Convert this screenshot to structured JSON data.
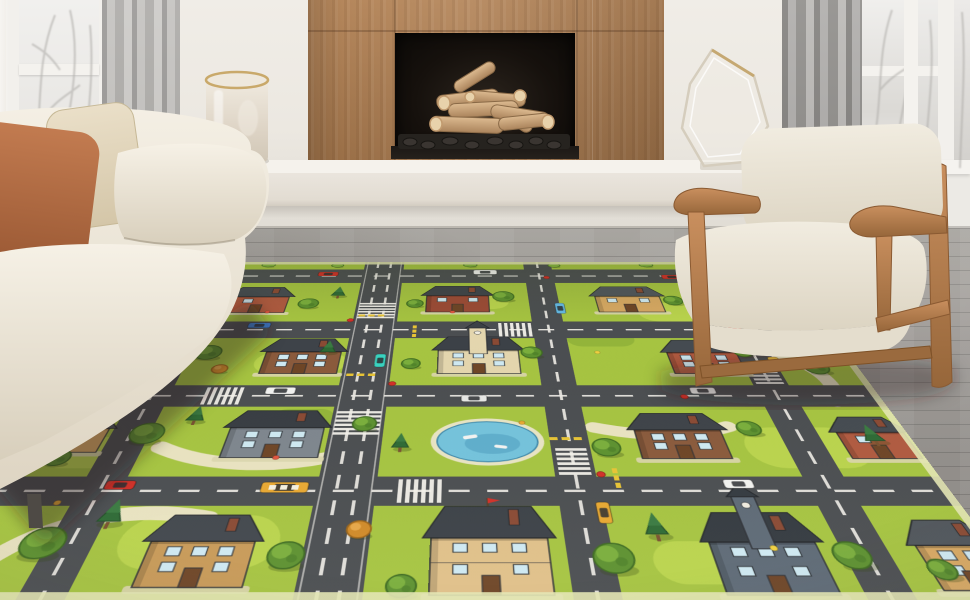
{
  "palette": {
    "wall": "#ece8e1",
    "floor1": "#a8a5a0",
    "floor2": "#8b8884",
    "wood1": "#b5875c",
    "wood2": "#9a6f47",
    "bench": "#f5f2ec",
    "benchFace": "#eae5dd",
    "curtL1": "#c2c0bd",
    "curtL2": "#979593",
    "curtR1": "#aeacaa",
    "curtR2": "#82807d",
    "sofa1": "#f4efe4",
    "sofa2": "#ded5c3",
    "pillowRust1": "#c27b50",
    "pillowRust2": "#9c5a35",
    "pillowCream1": "#eadfc8",
    "pillowCream2": "#d4c6a8",
    "chairWood1": "#c98f5e",
    "chairWood2": "#96663a",
    "chairFab1": "#f1ece0",
    "chairFab2": "#dcd4c2",
    "log1": "#dcba90",
    "log2": "#ab845c"
  },
  "objects": {
    "left_window": "snowy-window",
    "right_window": "snowy-window",
    "fireplace": "wood-surround-fireplace-with-logs",
    "bench": "floating-white-bench",
    "vase": "frosted-cylinder-vase",
    "sculpture": "glass-diamond-sculpture",
    "sofa": "cream-sofa-with-two-pillows",
    "armchair": "wood-frame-cream-armchair",
    "rug": "kids-city-road-play-rug"
  },
  "rug_map": {
    "width": 1100,
    "height": 760,
    "colors": {
      "grass": "#a6c441",
      "grassLight": "#bdd750",
      "grassDark": "#8fb239",
      "road": "#4b4e51",
      "roadLine": "#eceae4",
      "path": "#ece5c8",
      "treeDark": "#3e6b21",
      "tree1": "#5d9130",
      "tree2": "#7aae3c",
      "pine": "#2e6a35",
      "autumn": "#d08a28",
      "bush": "#86b53e",
      "pond": "#74c3dc",
      "pondDeep": "#4e9dc0",
      "sand": "#e8e4c4",
      "edge": "#e4e7b4",
      "terrace": "#dcd6ae",
      "yellow": "#e8c435",
      "red": "#d23028"
    },
    "h_roads": [
      {
        "y": 30,
        "h": 50
      },
      {
        "y": 210,
        "h": 50
      },
      {
        "y": 385,
        "h": 50
      },
      {
        "y": 575,
        "h": 50
      }
    ],
    "v_roads": [
      {
        "x": 130,
        "w": 48
      },
      {
        "x": 411,
        "w": 68
      },
      {
        "x": 676,
        "w": 48
      },
      {
        "x": 964,
        "w": 48
      }
    ],
    "patches": [
      {
        "x": 40,
        "y": 120,
        "w": 120,
        "h": 60,
        "t": "light"
      },
      {
        "x": 250,
        "y": 300,
        "w": 130,
        "h": 55,
        "t": "light"
      },
      {
        "x": 820,
        "y": 150,
        "w": 130,
        "h": 60,
        "t": "light"
      },
      {
        "x": 180,
        "y": 640,
        "w": 170,
        "h": 80,
        "t": "light"
      },
      {
        "x": 890,
        "y": 480,
        "w": 150,
        "h": 80,
        "t": "light"
      },
      {
        "x": 500,
        "y": 120,
        "w": 120,
        "h": 50,
        "t": "light"
      },
      {
        "x": 40,
        "y": 500,
        "w": 110,
        "h": 60,
        "t": "light"
      },
      {
        "x": 740,
        "y": 680,
        "w": 150,
        "h": 60,
        "t": "light"
      },
      {
        "x": 60,
        "y": 240,
        "w": 90,
        "h": 40,
        "t": "dark"
      },
      {
        "x": 700,
        "y": 240,
        "w": 100,
        "h": 44,
        "t": "dark"
      },
      {
        "x": 300,
        "y": 440,
        "w": 80,
        "h": 40,
        "t": "dark"
      }
    ],
    "paths": [
      "M30,760 C60,650 170,620 265,645",
      "M985,300 C1040,330 1060,380 1035,425",
      "M930,112 C1000,140 1040,180 1058,235",
      "M175,520 C240,558 320,560 382,540",
      "M710,480 C770,500 830,500 880,478"
    ],
    "pond": {
      "cx": 575,
      "cy": 508,
      "rx": 62,
      "ry": 40
    },
    "houses": [
      {
        "x": 170,
        "y": 96,
        "w": 96,
        "h": 86,
        "wall": "#b05a40",
        "roof": "#454b51",
        "type": "plain"
      },
      {
        "x": 488,
        "y": 92,
        "w": 100,
        "h": 88,
        "wall": "#9c4a36",
        "roof": "#3f444a",
        "type": "plain"
      },
      {
        "x": 760,
        "y": 94,
        "w": 104,
        "h": 86,
        "wall": "#d8a963",
        "roof": "#50565c",
        "type": "plain"
      },
      {
        "x": 1010,
        "y": 100,
        "w": 86,
        "h": 82,
        "wall": "#a84f38",
        "roof": "#44494f",
        "type": "plain"
      },
      {
        "x": 10,
        "y": 268,
        "w": 90,
        "h": 92,
        "wall": "#ab5340",
        "roof": "#474d53",
        "type": "plain"
      },
      {
        "x": 262,
        "y": 262,
        "w": 108,
        "h": 94,
        "wall": "#8a5a3c",
        "roof": "#3e4349",
        "type": "plain"
      },
      {
        "x": 510,
        "y": 256,
        "w": 116,
        "h": 100,
        "wall": "#e4d6ae",
        "roof": "#3c4147",
        "type": "tower"
      },
      {
        "x": 840,
        "y": 266,
        "w": 100,
        "h": 90,
        "wall": "#b05a40",
        "roof": "#454b51",
        "type": "plain"
      },
      {
        "x": 12,
        "y": 452,
        "w": 88,
        "h": 78,
        "wall": "#d8a963",
        "roof": "#50565c",
        "type": "plain"
      },
      {
        "x": 252,
        "y": 444,
        "w": 118,
        "h": 96,
        "wall": "#7e868e",
        "roof": "#383d43",
        "type": "plain"
      },
      {
        "x": 760,
        "y": 450,
        "w": 108,
        "h": 92,
        "wall": "#8a5a3c",
        "roof": "#3e4349",
        "type": "plain"
      },
      {
        "x": 1012,
        "y": 458,
        "w": 84,
        "h": 84,
        "wall": "#b05a40",
        "roof": "#454b51",
        "type": "plain"
      },
      {
        "x": 214,
        "y": 640,
        "w": 110,
        "h": 104,
        "wall": "#c89a58",
        "roof": "#42474d",
        "type": "plain"
      },
      {
        "x": 510,
        "y": 626,
        "w": 124,
        "h": 128,
        "wall": "#e0c089",
        "roof": "#3c4147",
        "type": "grand"
      },
      {
        "x": 804,
        "y": 636,
        "w": 112,
        "h": 118,
        "wall": "#5e6a76",
        "roof": "#343a40",
        "type": "tower"
      },
      {
        "x": 1020,
        "y": 648,
        "w": 80,
        "h": 100,
        "wall": "#d8a963",
        "roof": "#50565c",
        "type": "plain"
      }
    ],
    "trees": [
      [
        210,
        12,
        9,
        "bush"
      ],
      [
        330,
        14,
        8,
        "bush"
      ],
      [
        560,
        12,
        9,
        "bush"
      ],
      [
        705,
        14,
        8,
        "bush"
      ],
      [
        865,
        12,
        9,
        "bush"
      ],
      [
        1005,
        14,
        8,
        "bush"
      ],
      [
        44,
        130,
        18,
        "round"
      ],
      [
        86,
        172,
        12,
        "pine"
      ],
      [
        300,
        152,
        16,
        "round"
      ],
      [
        344,
        118,
        13,
        "pine"
      ],
      [
        470,
        152,
        13,
        "round"
      ],
      [
        612,
        128,
        17,
        "round"
      ],
      [
        884,
        142,
        15,
        "round"
      ],
      [
        933,
        112,
        11,
        "autumn"
      ],
      [
        1062,
        150,
        13,
        "round"
      ],
      [
        178,
        300,
        19,
        "round"
      ],
      [
        205,
        344,
        11,
        "autumn"
      ],
      [
        350,
        292,
        13,
        "pine"
      ],
      [
        472,
        330,
        13,
        "round"
      ],
      [
        645,
        300,
        15,
        "round"
      ],
      [
        950,
        300,
        12,
        "round"
      ],
      [
        1042,
        340,
        17,
        "round"
      ],
      [
        62,
        368,
        12,
        "pine"
      ],
      [
        150,
        492,
        21,
        "round"
      ],
      [
        202,
        458,
        13,
        "pine"
      ],
      [
        420,
        472,
        15,
        "round"
      ],
      [
        468,
        514,
        12,
        "pine"
      ],
      [
        720,
        520,
        17,
        "round"
      ],
      [
        905,
        482,
        15,
        "round"
      ],
      [
        58,
        540,
        15,
        "round"
      ],
      [
        1054,
        500,
        14,
        "pine"
      ],
      [
        100,
        682,
        23,
        "round"
      ],
      [
        158,
        642,
        15,
        "pine"
      ],
      [
        360,
        700,
        19,
        "round"
      ],
      [
        432,
        662,
        13,
        "autumn"
      ],
      [
        700,
        704,
        21,
        "round"
      ],
      [
        752,
        662,
        14,
        "pine"
      ],
      [
        948,
        700,
        19,
        "round"
      ],
      [
        482,
        742,
        15,
        "round"
      ],
      [
        1032,
        720,
        14,
        "round"
      ]
    ],
    "cars": [
      {
        "x": 318,
        "y": 47,
        "o": "h",
        "c": "#d03028"
      },
      {
        "x": 585,
        "y": 40,
        "o": "h",
        "c": "#f2f2f0",
        "van": 1
      },
      {
        "x": 900,
        "y": 58,
        "o": "h",
        "c": "#d03028"
      },
      {
        "x": 236,
        "y": 222,
        "o": "h",
        "c": "#3d7ccc"
      },
      {
        "x": 950,
        "y": 236,
        "o": "h",
        "c": "#d23028"
      },
      {
        "x": 700,
        "y": 168,
        "o": "v",
        "c": "#64b9e4"
      },
      {
        "x": 300,
        "y": 398,
        "o": "h",
        "c": "#f2f2f0",
        "van": 1
      },
      {
        "x": 560,
        "y": 416,
        "o": "h",
        "c": "#e8e8e6"
      },
      {
        "x": 868,
        "y": 398,
        "o": "h",
        "c": "#f2f2f0"
      },
      {
        "x": 428,
        "y": 322,
        "o": "v",
        "c": "#39d3c0"
      },
      {
        "x": 988,
        "y": 330,
        "o": "v",
        "c": "#e4b33c"
      },
      {
        "x": 150,
        "y": 590,
        "o": "h",
        "c": "#d03028"
      },
      {
        "x": 340,
        "y": 594,
        "o": "h",
        "c": "#e8a832",
        "bus": 1
      },
      {
        "x": 700,
        "y": 636,
        "o": "v",
        "c": "#e8a832"
      },
      {
        "x": 862,
        "y": 588,
        "o": "h",
        "c": "#f2f2f0"
      }
    ],
    "crosswalks": [
      {
        "o": "v",
        "x": 411,
        "y": 150
      },
      {
        "o": "v",
        "x": 411,
        "y": 445
      },
      {
        "o": "v",
        "x": 676,
        "y": 522
      },
      {
        "o": "v",
        "x": 964,
        "y": 332
      },
      {
        "o": "h",
        "x": 600,
        "y": 210
      },
      {
        "o": "h",
        "x": 470,
        "y": 575
      },
      {
        "o": "h",
        "x": 200,
        "y": 385
      }
    ],
    "yellow_dashes": [
      {
        "x": 384,
        "y": 188,
        "o": "h"
      },
      {
        "x": 384,
        "y": 356,
        "o": "h"
      },
      {
        "x": 652,
        "y": 500,
        "o": "h"
      },
      {
        "x": 940,
        "y": 300,
        "o": "h"
      },
      {
        "x": 470,
        "y": 222,
        "o": "v"
      },
      {
        "x": 720,
        "y": 560,
        "o": "v"
      }
    ],
    "red_dots": [
      [
        373,
        206
      ],
      [
        449,
        381
      ],
      [
        706,
        571
      ],
      [
        126,
        381
      ],
      [
        688,
        60
      ],
      [
        840,
        412
      ]
    ],
    "flowers": [
      {
        "x": 240,
        "y": 180,
        "c": "#e05540"
      },
      {
        "x": 620,
        "y": 470,
        "c": "#e8a832"
      },
      {
        "x": 320,
        "y": 540,
        "c": "#e05540"
      },
      {
        "x": 740,
        "y": 300,
        "c": "#f0d040"
      },
      {
        "x": 1005,
        "y": 190,
        "c": "#e05540"
      },
      {
        "x": 90,
        "y": 620,
        "c": "#e8a832"
      },
      {
        "x": 530,
        "y": 180,
        "c": "#e05540"
      },
      {
        "x": 870,
        "y": 690,
        "c": "#f0d040"
      }
    ]
  }
}
